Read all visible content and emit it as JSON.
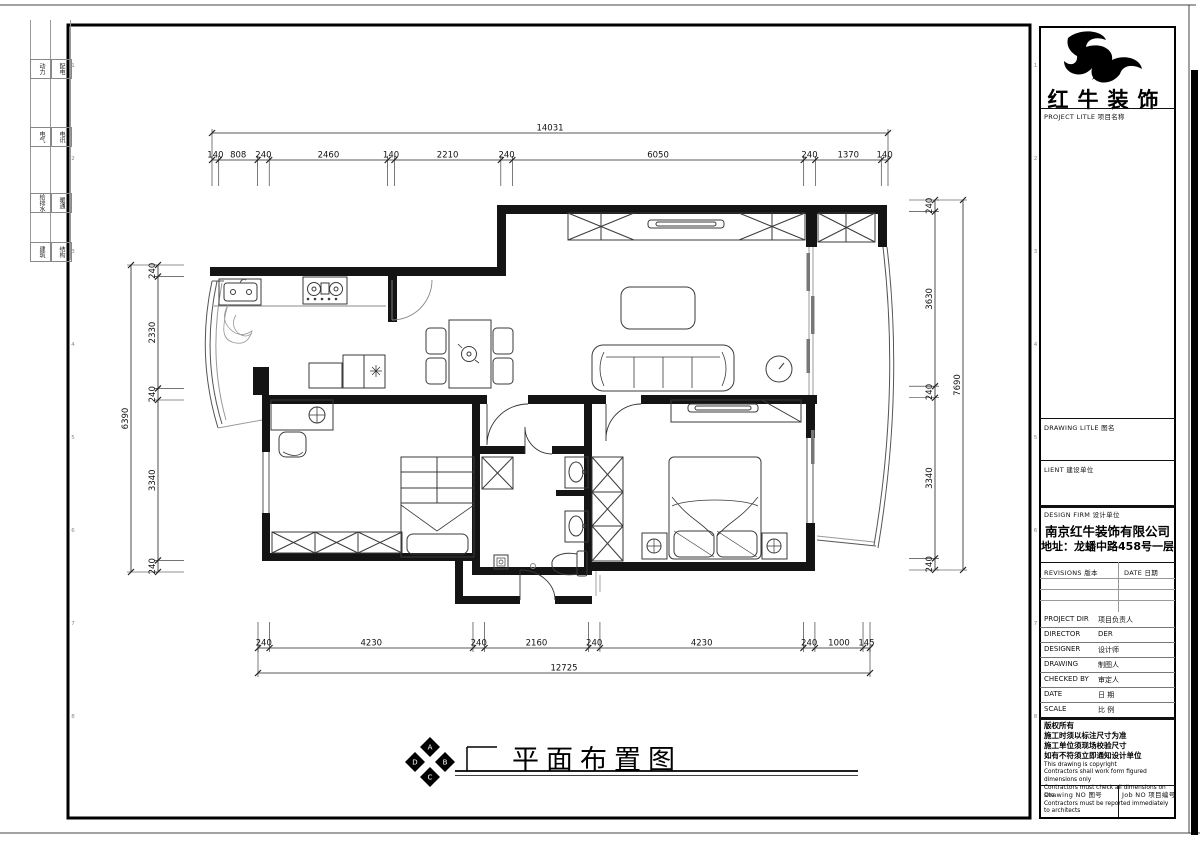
{
  "sheet": {
    "disciplines": [
      {
        "col1": "动力",
        "col2": "配电"
      },
      {
        "col1": "电气",
        "col2": "电讯"
      },
      {
        "col1": "给排水",
        "col2": "暖通"
      },
      {
        "col1": "建筑",
        "col2": "结构"
      }
    ],
    "grid_numbers": [
      "1",
      "2",
      "3",
      "4",
      "5",
      "6",
      "7",
      "8"
    ]
  },
  "title_block": {
    "brand": "红牛装饰",
    "project_title_label": "PROJECT LITLE  项目名称",
    "drawing_title_label": "DRAWING LITLE  图名",
    "client_label": "LIENT  建设单位",
    "design_firm_label": "DESIGN FIRM  设计单位",
    "company_name": "南京红牛装饰有限公司",
    "company_address": "地址：龙蟠中路458号一层",
    "revisions_label": "REVISIONS  版本",
    "revisions_date_label": "DATE  日期",
    "rows": [
      {
        "label": "PROJECT DIR",
        "value": "项目负责人"
      },
      {
        "label": "DIRECTOR",
        "value": "DER"
      },
      {
        "label": "DESIGNER",
        "value": "设计师"
      },
      {
        "label": "DRAWING",
        "value": "制图人"
      },
      {
        "label": "CHECKED BY",
        "value": "审定人"
      },
      {
        "label": "DATE",
        "value": "日  期"
      },
      {
        "label": "SCALE",
        "value": "比  例"
      }
    ],
    "notes_cn": [
      "版权所有",
      "施工时须以标注尺寸为准",
      "施工单位须现场校验尺寸",
      "如有不符须立即通知设计单位"
    ],
    "notes_en": [
      "This drawing is copyright",
      "Contractors shall work form figured dimensions only",
      "Contractors must check all dimensions on site",
      "Contractors must be reported immediately to architects"
    ],
    "drawing_no_label": "Drawing NO  图号",
    "job_no_label": "Job NO  项目编号"
  },
  "plan": {
    "title": "平面布置图",
    "compass_letters": [
      "A",
      "B",
      "C",
      "D"
    ],
    "dimensions": {
      "top": {
        "total": 14031,
        "segments": [
          140,
          808,
          240,
          2460,
          140,
          2210,
          240,
          6050,
          240,
          1370,
          140
        ]
      },
      "bottom": {
        "total": 12725,
        "segments": [
          240,
          4230,
          240,
          2160,
          240,
          4230,
          240,
          1000,
          145
        ]
      },
      "left": {
        "total": 6390,
        "segments": [
          240,
          2330,
          240,
          3340,
          240
        ]
      },
      "right": {
        "total": 7690,
        "segments": [
          240,
          3630,
          240,
          3340,
          240
        ]
      }
    }
  }
}
